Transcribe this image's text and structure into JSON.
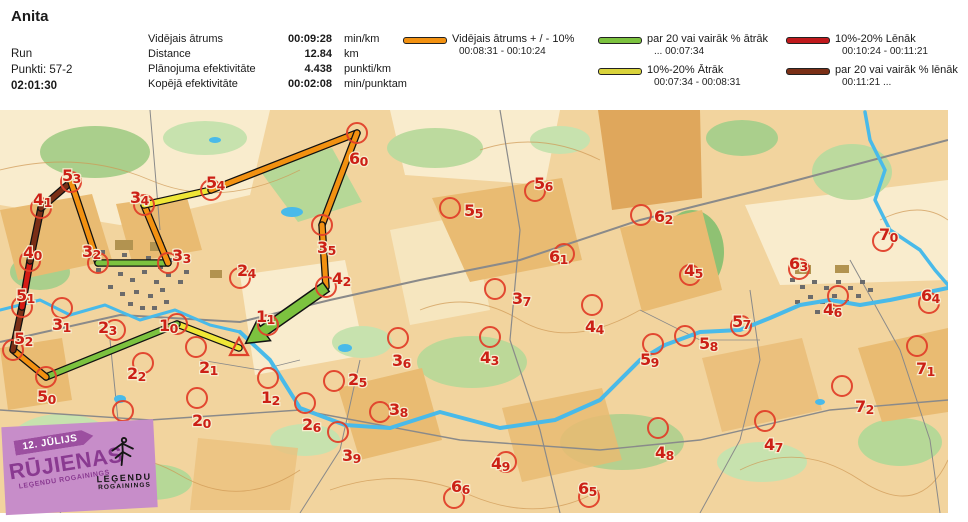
{
  "header": {
    "title": "Anita",
    "activity": "Run",
    "points": "Punkti: 57-2",
    "total_time": "02:01:30",
    "stats": [
      {
        "label": "Vidējais ātrums",
        "value": "00:09:28",
        "unit": "min/km"
      },
      {
        "label": "Distance",
        "value": "12.84",
        "unit": "km"
      },
      {
        "label": "Plānojuma efektivitāte",
        "value": "4.438",
        "unit": "punkti/km"
      },
      {
        "label": "Kopējā efektivitāte",
        "value": "00:02:08",
        "unit": "min/punktam"
      }
    ]
  },
  "colors": {
    "orange": "#F29111",
    "green": "#7CC23F",
    "yellow": "#EFE636",
    "red": "#D61C15",
    "brown": "#7A2F16",
    "control": "#E0402A",
    "control_text": "#CC2016"
  },
  "legend": {
    "items": [
      {
        "color": "#F29111",
        "label": "Vidējais ātrums + / - 10%",
        "range": "00:08:31   -   00:10:24"
      },
      {
        "color": "#7CC23F",
        "label": "par 20 vai vairāk % ātrāk",
        "range": "...   00:07:34"
      },
      {
        "color": "#D9D33B",
        "label": "10%-20% Ātrāk",
        "range": "00:07:34   -   00:08:31"
      },
      {
        "color": "#C0191C",
        "label": "10%-20% Lēnāk",
        "range": "00:10:24   -  00:11:21"
      },
      {
        "color": "#7A2F16",
        "label": "par 20 vai vairāk % lēnāk",
        "range": "00:11:21   ..."
      }
    ]
  },
  "map": {
    "start_finish": {
      "x": 239,
      "y": 238
    },
    "controls": [
      {
        "id": "10",
        "cx": 177,
        "cy": 214,
        "lx": 159,
        "ly": 221
      },
      {
        "id": "32",
        "cx": 98,
        "cy": 153,
        "lx": 82,
        "ly": 147
      },
      {
        "id": "33",
        "cx": 168,
        "cy": 153,
        "lx": 172,
        "ly": 151
      },
      {
        "id": "34",
        "cx": 144,
        "cy": 95,
        "lx": 130,
        "ly": 93
      },
      {
        "id": "35",
        "cx": 322,
        "cy": 115,
        "lx": 317,
        "ly": 143
      },
      {
        "id": "40",
        "cx": 30,
        "cy": 151,
        "lx": 23,
        "ly": 148
      },
      {
        "id": "41",
        "cx": 41,
        "cy": 98,
        "lx": 33,
        "ly": 95
      },
      {
        "id": "42",
        "cx": 326,
        "cy": 177,
        "lx": 332,
        "ly": 174
      },
      {
        "id": "50",
        "cx": 46,
        "cy": 267,
        "lx": 37,
        "ly": 292
      },
      {
        "id": "51",
        "cx": 22,
        "cy": 197,
        "lx": 16,
        "ly": 191
      },
      {
        "id": "52",
        "cx": 13,
        "cy": 240,
        "lx": 14,
        "ly": 234
      },
      {
        "id": "53",
        "cx": 71,
        "cy": 72,
        "lx": 62,
        "ly": 71
      },
      {
        "id": "54",
        "cx": 211,
        "cy": 80,
        "lx": 206,
        "ly": 78
      },
      {
        "id": "60",
        "cx": 357,
        "cy": 23,
        "lx": 349,
        "ly": 54
      },
      {
        "id": "11",
        "cx": 268,
        "cy": 215,
        "lx": 256,
        "ly": 212
      },
      {
        "id": "12",
        "cx": 268,
        "cy": 268,
        "lx": 261,
        "ly": 293
      },
      {
        "id": "20",
        "cx": 197,
        "cy": 288,
        "lx": 192,
        "ly": 316
      },
      {
        "id": "21",
        "cx": 196,
        "cy": 237,
        "lx": 199,
        "ly": 263
      },
      {
        "id": "22",
        "cx": 143,
        "cy": 253,
        "lx": 127,
        "ly": 269
      },
      {
        "id": "23",
        "cx": 115,
        "cy": 220,
        "lx": 98,
        "ly": 223
      },
      {
        "id": "24",
        "cx": 240,
        "cy": 168,
        "lx": 237,
        "ly": 166
      },
      {
        "id": "25",
        "cx": 334,
        "cy": 271,
        "lx": 348,
        "ly": 275
      },
      {
        "id": "26",
        "cx": 305,
        "cy": 293,
        "lx": 302,
        "ly": 320
      },
      {
        "id": "30",
        "cx": 123,
        "cy": 301,
        "lx": 113,
        "ly": 325
      },
      {
        "id": "31",
        "cx": 62,
        "cy": 198,
        "lx": 52,
        "ly": 220
      },
      {
        "id": "36",
        "cx": 398,
        "cy": 228,
        "lx": 392,
        "ly": 256
      },
      {
        "id": "37",
        "cx": 495,
        "cy": 179,
        "lx": 512,
        "ly": 194
      },
      {
        "id": "38",
        "cx": 380,
        "cy": 302,
        "lx": 389,
        "ly": 305
      },
      {
        "id": "39",
        "cx": 338,
        "cy": 322,
        "lx": 342,
        "ly": 351
      },
      {
        "id": "43",
        "cx": 490,
        "cy": 227,
        "lx": 480,
        "ly": 253
      },
      {
        "id": "44",
        "cx": 592,
        "cy": 195,
        "lx": 585,
        "ly": 222
      },
      {
        "id": "45",
        "cx": 690,
        "cy": 165,
        "lx": 684,
        "ly": 166
      },
      {
        "id": "46",
        "cx": 838,
        "cy": 186,
        "lx": 823,
        "ly": 205
      },
      {
        "id": "47",
        "cx": 765,
        "cy": 311,
        "lx": 764,
        "ly": 340
      },
      {
        "id": "48",
        "cx": 658,
        "cy": 318,
        "lx": 655,
        "ly": 348
      },
      {
        "id": "49",
        "cx": 506,
        "cy": 352,
        "lx": 491,
        "ly": 359
      },
      {
        "id": "55",
        "cx": 450,
        "cy": 98,
        "lx": 464,
        "ly": 106
      },
      {
        "id": "56",
        "cx": 535,
        "cy": 81,
        "lx": 534,
        "ly": 79
      },
      {
        "id": "57",
        "cx": 741,
        "cy": 216,
        "lx": 732,
        "ly": 217
      },
      {
        "id": "58",
        "cx": 685,
        "cy": 226,
        "lx": 699,
        "ly": 239
      },
      {
        "id": "59",
        "cx": 653,
        "cy": 234,
        "lx": 640,
        "ly": 255
      },
      {
        "id": "61",
        "cx": 564,
        "cy": 144,
        "lx": 549,
        "ly": 152
      },
      {
        "id": "62",
        "cx": 641,
        "cy": 105,
        "lx": 654,
        "ly": 112
      },
      {
        "id": "63",
        "cx": 799,
        "cy": 159,
        "lx": 789,
        "ly": 159
      },
      {
        "id": "64",
        "cx": 929,
        "cy": 193,
        "lx": 921,
        "ly": 191
      },
      {
        "id": "65",
        "cx": 589,
        "cy": 387,
        "lx": 578,
        "ly": 384
      },
      {
        "id": "66",
        "cx": 454,
        "cy": 388,
        "lx": 451,
        "ly": 382
      },
      {
        "id": "70",
        "cx": 883,
        "cy": 131,
        "lx": 879,
        "ly": 130
      },
      {
        "id": "71",
        "cx": 917,
        "cy": 236,
        "lx": 916,
        "ly": 264
      },
      {
        "id": "72",
        "cx": 842,
        "cy": 276,
        "lx": 855,
        "ly": 302
      }
    ],
    "route": [
      {
        "from": "finish",
        "to": "10",
        "speed": "yellow"
      },
      {
        "from": "10",
        "to": "50",
        "speed": "green"
      },
      {
        "from": "50",
        "to": "52",
        "speed": "orange"
      },
      {
        "from": "52",
        "to": "51",
        "speed": "brown"
      },
      {
        "from": "51",
        "to": "40",
        "speed": "red"
      },
      {
        "from": "40",
        "to": "41",
        "speed": "brown"
      },
      {
        "from": "41",
        "to": "53",
        "speed": "brown"
      },
      {
        "from": "53",
        "to": "32",
        "speed": "orange"
      },
      {
        "from": "32",
        "to": "33",
        "speed": "green"
      },
      {
        "from": "33",
        "to": "34",
        "speed": "orange"
      },
      {
        "from": "34",
        "to": "54",
        "speed": "yellow"
      },
      {
        "from": "54",
        "to": "60",
        "speed": "orange"
      },
      {
        "from": "60",
        "to": "35",
        "speed": "orange"
      },
      {
        "from": "35",
        "to": "42",
        "speed": "orange"
      },
      {
        "from": "42",
        "to": "finish",
        "speed": "green",
        "arrow": true
      }
    ]
  },
  "logo": {
    "date": "12. JŪLIJS",
    "city": "RŪJIENAS",
    "subtitle": "LEĢENDU ROGAININGS",
    "brand_line1": "LEĢENDU",
    "brand_line2": "ROGAININGS"
  }
}
